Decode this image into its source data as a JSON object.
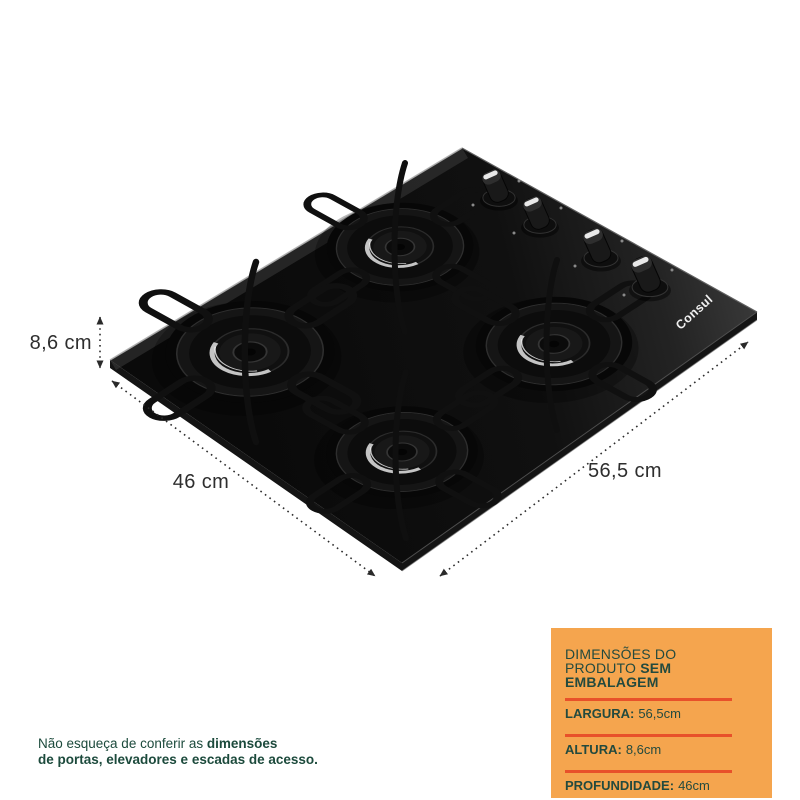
{
  "image": {
    "background": "#ffffff"
  },
  "product": {
    "brand": "Consul",
    "type": "gas-cooktop-4-burners",
    "surface_color": "#0d0d0d"
  },
  "dimensions": {
    "height": "8,6 cm",
    "depth": "46 cm",
    "width": "56,5 cm"
  },
  "spec_box": {
    "background": "#F5A54E",
    "divider_color": "#E8512A",
    "text_color": "#234A3E",
    "title_line1": "DIMENSÕES DO",
    "title_line2_regular": "PRODUTO ",
    "title_line2_bold": "SEM",
    "title_line3_bold": "EMBALAGEM",
    "rows": [
      {
        "label": "LARGURA:",
        "value": "56,5cm"
      },
      {
        "label": "ALTURA:",
        "value": "8,6cm"
      },
      {
        "label": "PROFUNDIDADE:",
        "value": "46cm"
      }
    ]
  },
  "footnote": {
    "text_color": "#1C4A3C",
    "line1_regular": "Não esqueça de conferir as ",
    "line1_bold": "dimensões",
    "line2_bold": "de portas, elevadores e escadas de acesso."
  }
}
